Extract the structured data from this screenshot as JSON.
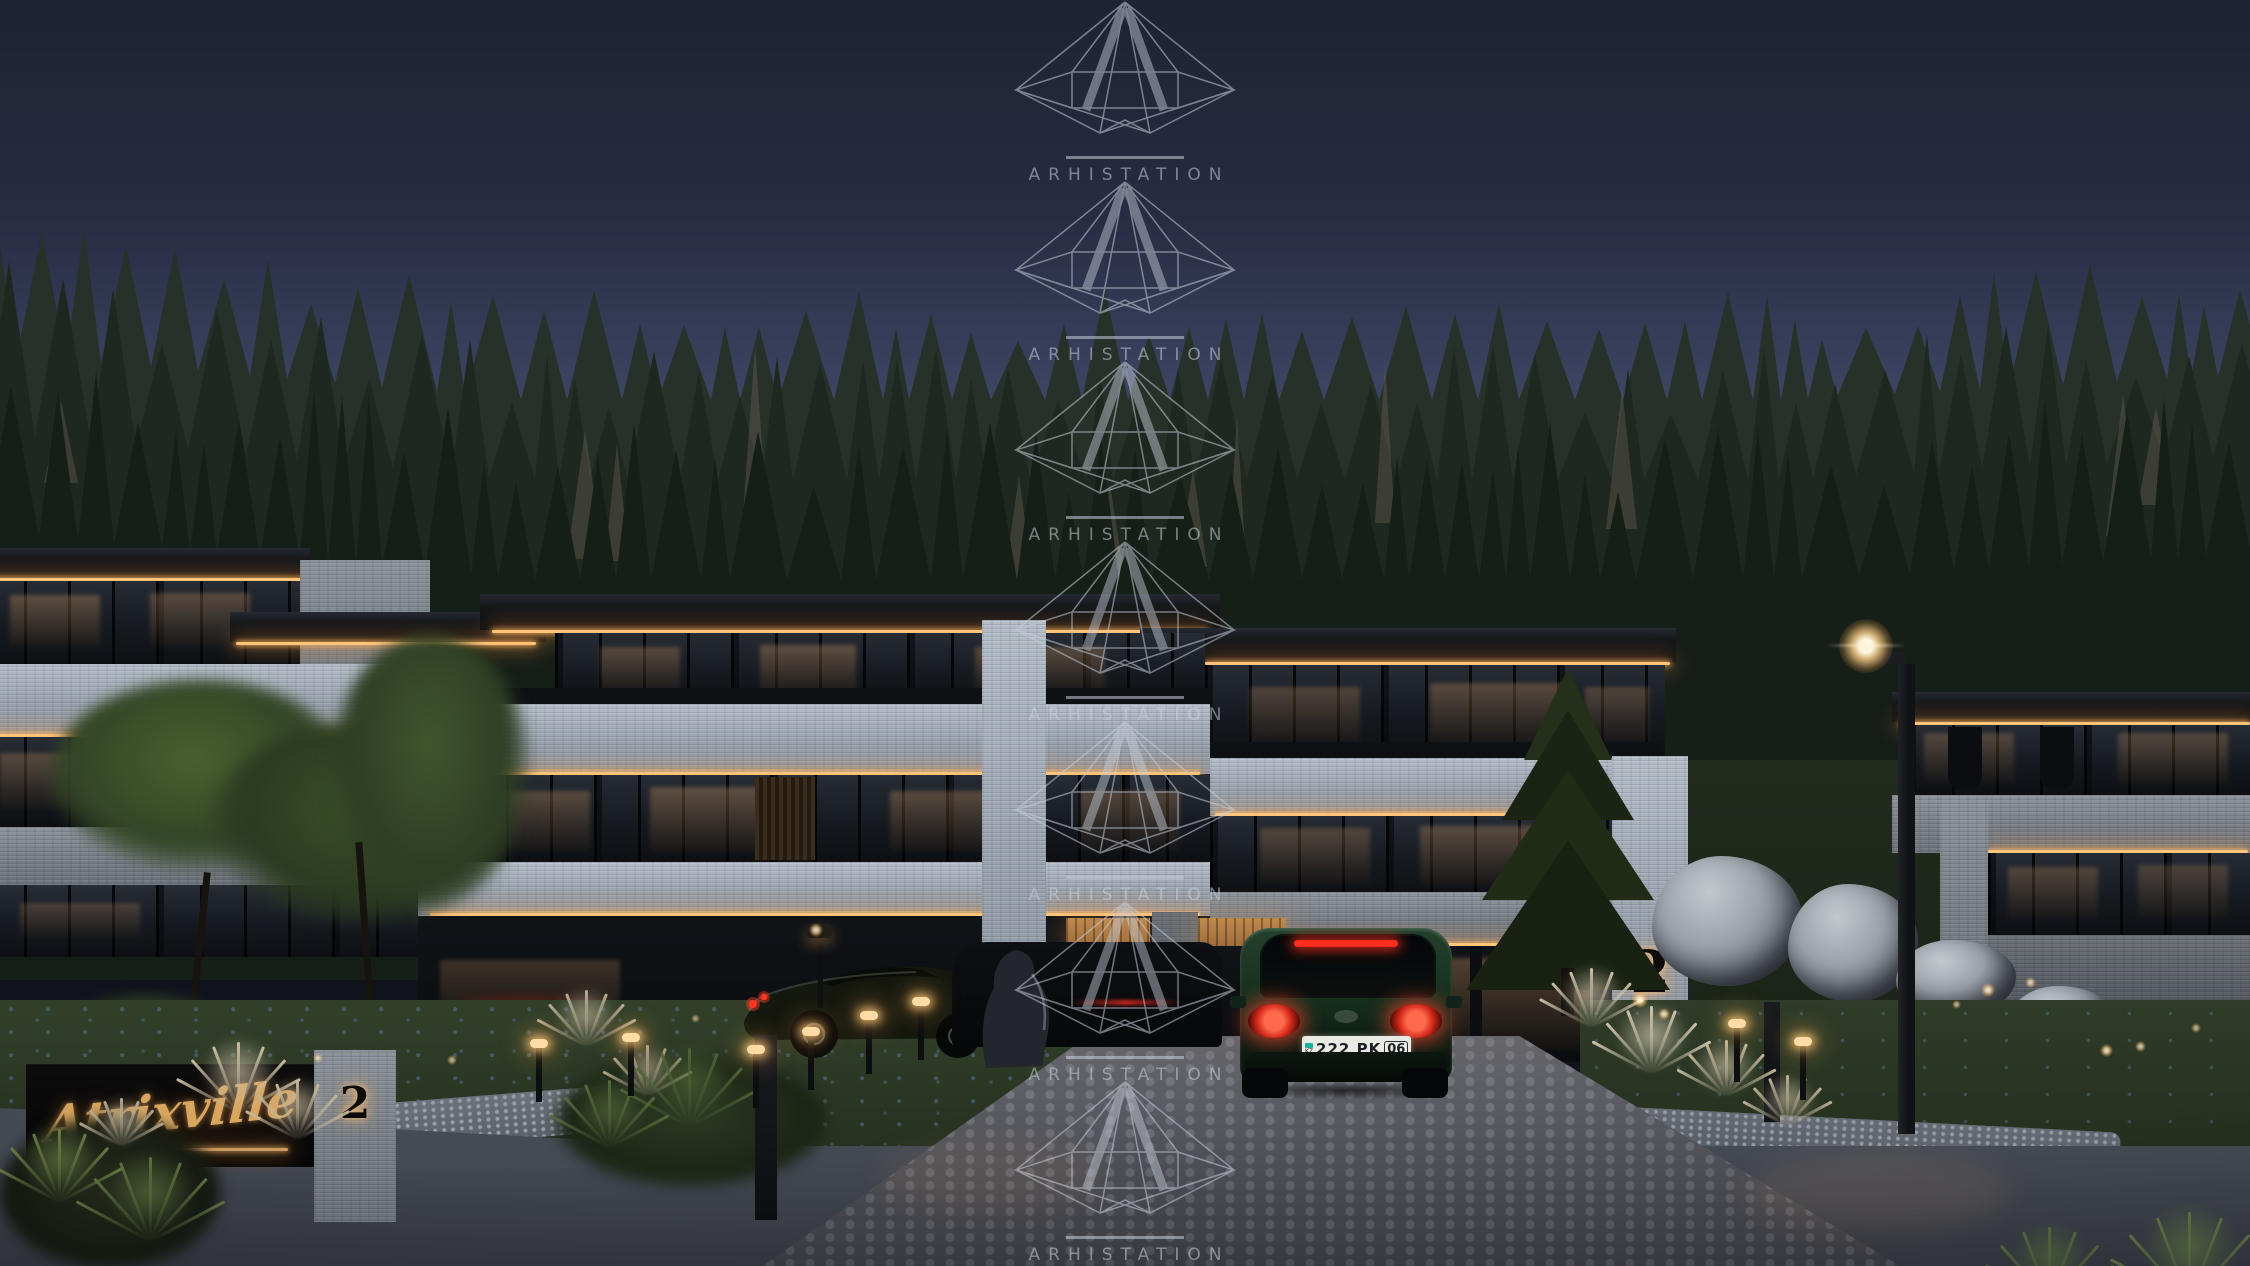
{
  "watermark": {
    "brand": "ARHISTATION",
    "logo_icon": "diamond-logo",
    "count": 7,
    "color": "#c6cdd9"
  },
  "sign": {
    "name": "Atrixville",
    "number": "2",
    "text_color": "#d9a660"
  },
  "building": {
    "number": "2"
  },
  "vehicle": {
    "plate": "222 PK",
    "plate_suffix": "06",
    "country_code": "KZ",
    "body_color": "#16301f",
    "taillight_color": "#ff3b28"
  },
  "colors": {
    "sky_top": "#1e2333",
    "sky_horizon": "#4a5170",
    "forest_light": "#27312a",
    "forest_dark": "#161e18",
    "dead_tree": "#6e6556",
    "stone": "#a9b2bd",
    "led_warm": "#ffc37a",
    "glass_dark": "#14171c",
    "warm_interior": "#c98a4e",
    "driveway": "#5e5f66",
    "asphalt": "#3f434c",
    "lawn": "#32402a",
    "sign_gold": "#d9a660",
    "watermark": "#c6cdd9"
  }
}
